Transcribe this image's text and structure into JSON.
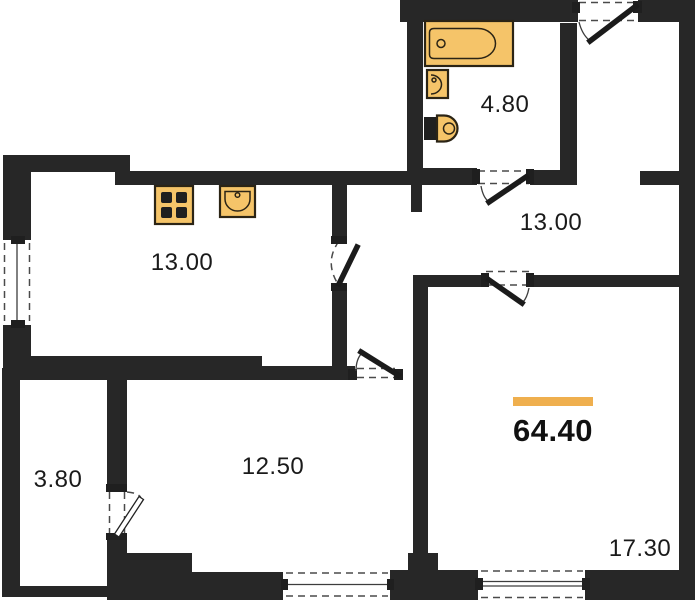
{
  "plan": {
    "total_area": "64.40",
    "colors": {
      "wall": "#272727",
      "fixture": "#F5C469",
      "accent_bar": "#EFAF4E",
      "background": "#FFFFFF"
    },
    "rooms": [
      {
        "name": "kitchen",
        "area": "13.00"
      },
      {
        "name": "bathroom",
        "area": "4.80"
      },
      {
        "name": "hallway",
        "area": "13.00"
      },
      {
        "name": "bedroom",
        "area": "12.50"
      },
      {
        "name": "storage",
        "area": "3.80"
      },
      {
        "name": "living-room",
        "area": "17.30"
      }
    ],
    "fixtures": [
      "bathtub-icon",
      "bathroom-sink-icon",
      "toilet-icon",
      "stove-icon",
      "kitchen-sink-icon"
    ]
  }
}
